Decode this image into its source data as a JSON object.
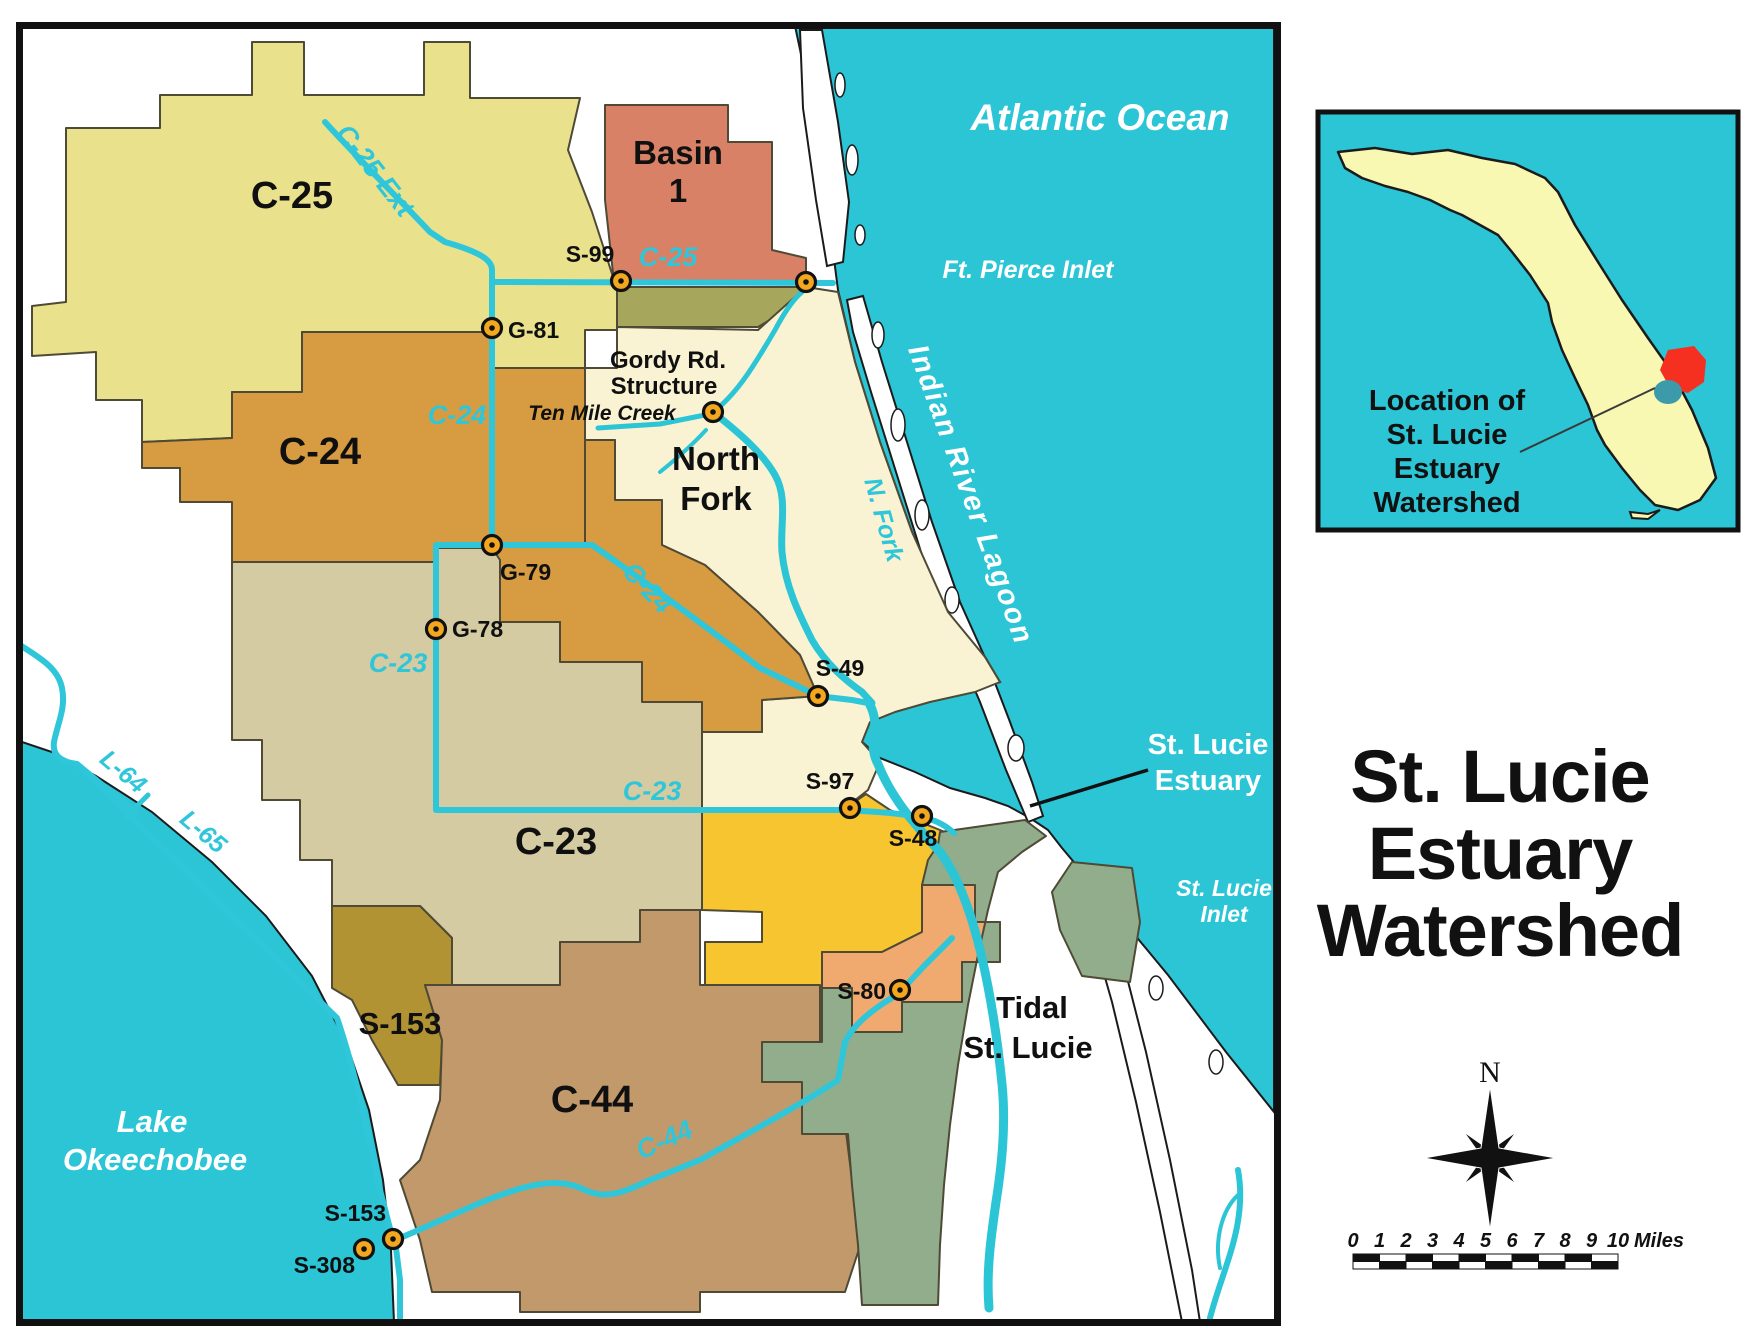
{
  "title": {
    "lines": [
      "St. Lucie",
      "Estuary",
      "Watershed"
    ]
  },
  "inset": {
    "caption_lines": [
      "Location of",
      "St. Lucie",
      "Estuary",
      "Watershed"
    ]
  },
  "compass": {
    "north_label": "N"
  },
  "scale_bar": {
    "ticks": [
      "0",
      "1",
      "2",
      "3",
      "4",
      "5",
      "6",
      "7",
      "8",
      "9",
      "10"
    ],
    "unit": "Miles"
  },
  "map": {
    "colors": {
      "water": "#2bc5d6",
      "canal": "#2fc6da",
      "c25": "#e9e18c",
      "basin1": "#d98166",
      "olive": "#a6a75c",
      "north_fork": "#f9f3d3",
      "c24": "#d79b41",
      "c23": "#d5cba3",
      "basin_yellow": "#f6c52f",
      "basin_orange": "#f0aa70",
      "tidal": "#92ad8c",
      "c44": "#c2996a",
      "s153": "#b29334",
      "structure": "#f2a71e",
      "florida": "#f8f8b2",
      "inset_red": "#f53020",
      "inset_lake": "#3c9aaa"
    },
    "labels": [
      {
        "name": "region-label-c25",
        "text": "C-25",
        "x": 292,
        "y": 208,
        "size": 38
      },
      {
        "name": "region-label-basin1-line1",
        "text": "Basin",
        "x": 678,
        "y": 164,
        "size": 33
      },
      {
        "name": "region-label-basin1-line2",
        "text": "1",
        "x": 678,
        "y": 202,
        "size": 33
      },
      {
        "name": "region-label-c24",
        "text": "C-24",
        "x": 320,
        "y": 464,
        "size": 38
      },
      {
        "name": "region-label-northfork-line1",
        "text": "North",
        "x": 716,
        "y": 470,
        "size": 33
      },
      {
        "name": "region-label-northfork-line2",
        "text": "Fork",
        "x": 716,
        "y": 510,
        "size": 33
      },
      {
        "name": "region-label-c23",
        "text": "C-23",
        "x": 556,
        "y": 854,
        "size": 38
      },
      {
        "name": "region-label-s153",
        "text": "S-153",
        "x": 400,
        "y": 1034,
        "size": 31
      },
      {
        "name": "region-label-c44",
        "text": "C-44",
        "x": 592,
        "y": 1112,
        "size": 38
      },
      {
        "name": "region-label-tidal-line1",
        "text": "Tidal",
        "x": 1032,
        "y": 1018,
        "size": 31
      },
      {
        "name": "region-label-tidal-line2",
        "text": "St. Lucie",
        "x": 1028,
        "y": 1058,
        "size": 31
      },
      {
        "name": "label-gordy-line1",
        "text": "Gordy Rd.",
        "x": 668,
        "y": 368,
        "size": 24
      },
      {
        "name": "label-gordy-line2",
        "text": "Structure",
        "x": 664,
        "y": 394,
        "size": 24
      },
      {
        "name": "label-ten-mile-creek",
        "text": "Ten Mile Creek",
        "x": 602,
        "y": 420,
        "size": 21,
        "style": "italic"
      },
      {
        "name": "label-atlantic-ocean",
        "text": "Atlantic Ocean",
        "x": 1100,
        "y": 130,
        "size": 37,
        "color": "#ffffff",
        "style": "italic"
      },
      {
        "name": "label-ft-pierce-inlet",
        "text": "Ft. Pierce Inlet",
        "x": 1028,
        "y": 278,
        "size": 25,
        "color": "#ffffff",
        "style": "italic"
      },
      {
        "name": "label-indian-river-lagoon",
        "text": "Indian River Lagoon",
        "x": 962,
        "y": 498,
        "size": 29,
        "color": "#ffffff",
        "style": "italic",
        "rotate": 70,
        "spacing": 2
      },
      {
        "name": "label-n-fork",
        "text": "N. Fork",
        "x": 876,
        "y": 522,
        "size": 25,
        "color": "#2fc6da",
        "style": "italic",
        "rotate": 74
      },
      {
        "name": "label-st-lucie-estuary-line1",
        "text": "St. Lucie",
        "x": 1208,
        "y": 754,
        "size": 29,
        "color": "#ffffff"
      },
      {
        "name": "label-st-lucie-estuary-line2",
        "text": "Estuary",
        "x": 1208,
        "y": 790,
        "size": 29,
        "color": "#ffffff"
      },
      {
        "name": "label-st-lucie-inlet-line1",
        "text": "St. Lucie",
        "x": 1224,
        "y": 896,
        "size": 23,
        "color": "#ffffff",
        "style": "italic"
      },
      {
        "name": "label-st-lucie-inlet-line2",
        "text": "Inlet",
        "x": 1224,
        "y": 922,
        "size": 23,
        "color": "#ffffff",
        "style": "italic"
      },
      {
        "name": "label-lake-okeechobee-line1",
        "text": "Lake",
        "x": 152,
        "y": 1132,
        "size": 31,
        "color": "#ffffff",
        "style": "italic"
      },
      {
        "name": "label-lake-okeechobee-line2",
        "text": "Okeechobee",
        "x": 155,
        "y": 1170,
        "size": 31,
        "color": "#ffffff",
        "style": "italic"
      },
      {
        "name": "canal-label-c25-ext",
        "text": "C-25 Ext",
        "x": 368,
        "y": 176,
        "size": 27,
        "color": "#2fc6da",
        "style": "italic",
        "rotate": 52
      },
      {
        "name": "canal-label-c25",
        "text": "C-25",
        "x": 668,
        "y": 266,
        "size": 27,
        "color": "#2fc6da",
        "style": "italic"
      },
      {
        "name": "canal-label-c24-upper",
        "text": "C-24",
        "x": 457,
        "y": 424,
        "size": 27,
        "color": "#2fc6da",
        "style": "italic"
      },
      {
        "name": "canal-label-c24-lower",
        "text": "C-24",
        "x": 641,
        "y": 594,
        "size": 27,
        "color": "#2fc6da",
        "style": "italic",
        "rotate": 47
      },
      {
        "name": "canal-label-c23-upper",
        "text": "C-23",
        "x": 398,
        "y": 672,
        "size": 27,
        "color": "#2fc6da",
        "style": "italic"
      },
      {
        "name": "canal-label-c23-lower",
        "text": "C-23",
        "x": 652,
        "y": 800,
        "size": 27,
        "color": "#2fc6da",
        "style": "italic"
      },
      {
        "name": "canal-label-c44",
        "text": "C-44",
        "x": 668,
        "y": 1148,
        "size": 27,
        "color": "#2fc6da",
        "style": "italic",
        "rotate": -24
      },
      {
        "name": "canal-label-l64",
        "text": "L-64",
        "x": 118,
        "y": 778,
        "size": 25,
        "color": "#2fc6da",
        "style": "italic",
        "rotate": 40
      },
      {
        "name": "canal-label-l65",
        "text": "L-65",
        "x": 198,
        "y": 838,
        "size": 25,
        "color": "#2fc6da",
        "style": "italic",
        "rotate": 40
      }
    ],
    "structures": [
      {
        "name": "structure-s99",
        "label": "S-99",
        "x": 621,
        "y": 281,
        "lx": 590,
        "ly": 262,
        "anchor": "middle"
      },
      {
        "name": "structure-ft-pierce",
        "label": "",
        "x": 806,
        "y": 282
      },
      {
        "name": "structure-g81",
        "label": "G-81",
        "x": 492,
        "y": 328,
        "lx": 508,
        "ly": 338,
        "anchor": "start"
      },
      {
        "name": "structure-gordy-rd",
        "label": "",
        "x": 713,
        "y": 412
      },
      {
        "name": "structure-g79",
        "label": "G-79",
        "x": 492,
        "y": 545,
        "lx": 500,
        "ly": 580,
        "anchor": "start"
      },
      {
        "name": "structure-g78",
        "label": "G-78",
        "x": 436,
        "y": 629,
        "lx": 452,
        "ly": 637,
        "anchor": "start"
      },
      {
        "name": "structure-s49",
        "label": "S-49",
        "x": 818,
        "y": 696,
        "lx": 840,
        "ly": 676,
        "anchor": "middle"
      },
      {
        "name": "structure-s97",
        "label": "S-97",
        "x": 850,
        "y": 808,
        "lx": 830,
        "ly": 789,
        "anchor": "middle"
      },
      {
        "name": "structure-s48",
        "label": "S-48",
        "x": 922,
        "y": 816,
        "lx": 913,
        "ly": 846,
        "anchor": "middle"
      },
      {
        "name": "structure-s80",
        "label": "S-80",
        "x": 900,
        "y": 990,
        "lx": 886,
        "ly": 999,
        "anchor": "end"
      },
      {
        "name": "structure-s153",
        "label": "S-153",
        "x": 393,
        "y": 1239,
        "lx": 386,
        "ly": 1221,
        "anchor": "end"
      },
      {
        "name": "structure-s308",
        "label": "S-308",
        "x": 364,
        "y": 1249,
        "lx": 355,
        "ly": 1273,
        "anchor": "end"
      }
    ]
  }
}
